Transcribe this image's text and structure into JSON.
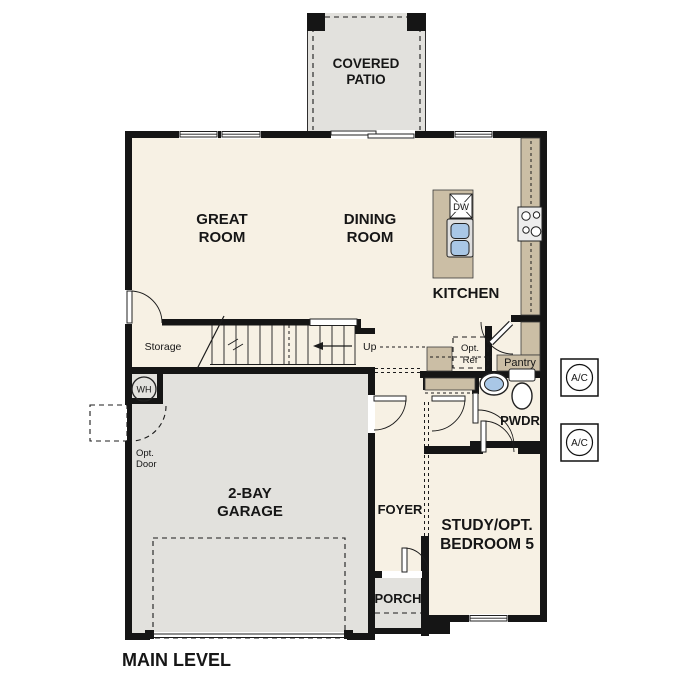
{
  "plan_title": "MAIN LEVEL",
  "labels": {
    "covered_patio": {
      "line1": "COVERED",
      "line2": "PATIO"
    },
    "great_room": {
      "line1": "GREAT",
      "line2": "ROOM"
    },
    "dining_room": {
      "line1": "DINING",
      "line2": "ROOM"
    },
    "kitchen": "KITCHEN",
    "storage": "Storage",
    "stairs_up": "Up",
    "pantry": "Pantry",
    "opt_ref": {
      "line1": "Opt.",
      "line2": "Ref"
    },
    "powder_room": "PWDR",
    "water_heater": "WH",
    "dishwasher": "DW",
    "opt_door": {
      "line1": "Opt.",
      "line2": "Door"
    },
    "garage": {
      "line1": "2-BAY",
      "line2": "GARAGE"
    },
    "foyer": "FOYER",
    "study": {
      "line1": "STUDY/OPT.",
      "line2": "BEDROOM 5"
    },
    "porch": "PORCH",
    "ac_unit": "A/C"
  },
  "colors": {
    "wall": "#151515",
    "floor": "#f7f1e4",
    "outdoor": "#e2e1dd",
    "counter": "#cbbea5",
    "appliance": "#ededed",
    "sink_blue": "#a9c7e6",
    "sink_tray": "#dfdfdf",
    "opt_ref_fill": "#e8e8e8"
  }
}
